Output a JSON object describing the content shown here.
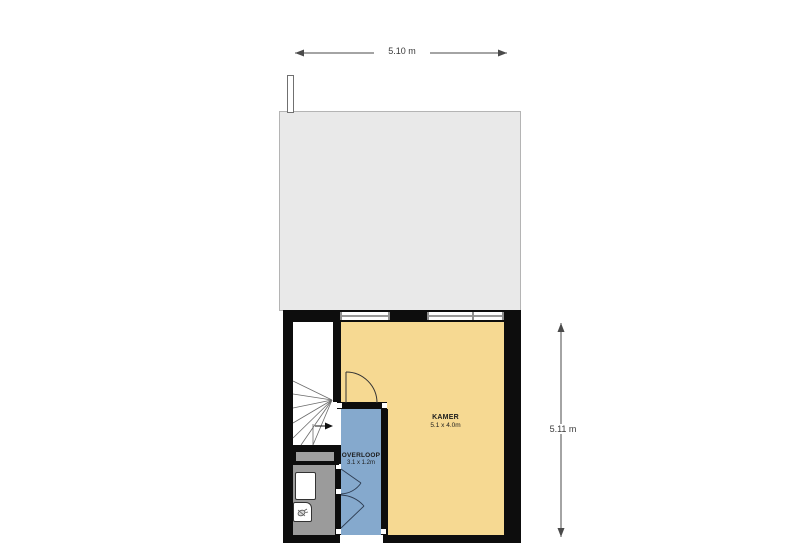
{
  "plan": {
    "type": "floor-plan",
    "dimensions": {
      "width_label": "5.10 m",
      "height_label": "5.11 m"
    },
    "rooms": {
      "kamer": {
        "name": "KAMER",
        "size": "5.1 x 4.0m",
        "color": "#F6D992"
      },
      "overloop": {
        "name": "OVERLOOP",
        "size": "3.1 x 1.2m",
        "color": "#85A9CD"
      },
      "bathroom": {
        "color": "#9B9B9B"
      },
      "stairwell": {
        "color": "#FFFFFF"
      }
    },
    "colors": {
      "wall": "#0D0D0D",
      "roof": "#E9E9E9",
      "roof_border": "#B4B4B4",
      "background": "#FFFFFF",
      "line": "#4A4A4A",
      "cupboard_inset": "#A0A0A0"
    },
    "icons": {
      "stairs_direction": "right-arrow-icon",
      "shower": "shower-spray-icon",
      "dimension_top": "horizontal-double-arrow-icon",
      "dimension_right": "vertical-double-arrow-icon"
    }
  }
}
